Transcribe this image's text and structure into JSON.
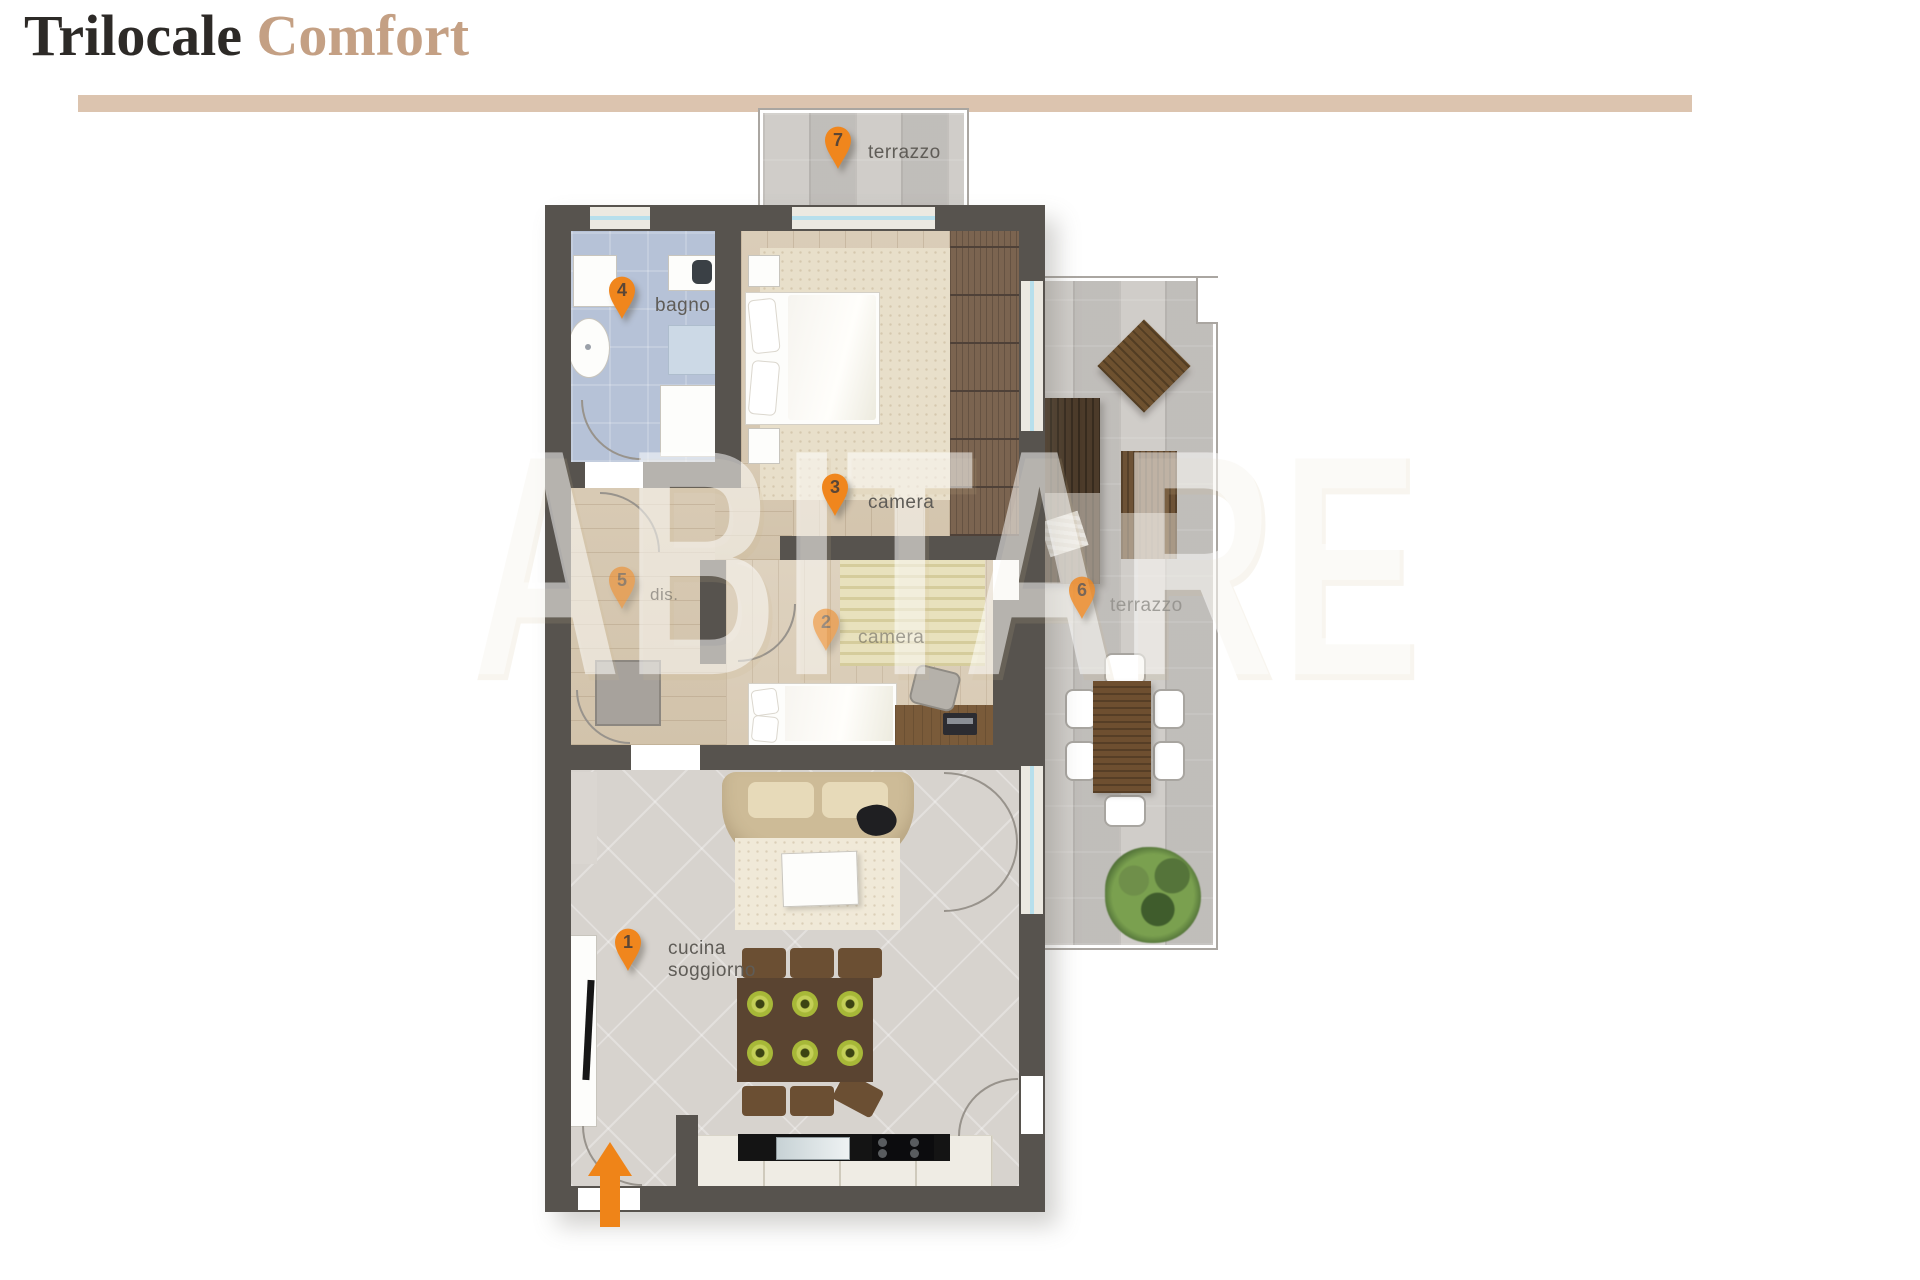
{
  "header": {
    "title_primary": "Trilocale",
    "title_accent": "Comfort"
  },
  "watermark": {
    "text": "ABITARE"
  },
  "markers": [
    {
      "num": "1",
      "label": "cucina soggiorno"
    },
    {
      "num": "2",
      "label": "camera"
    },
    {
      "num": "3",
      "label": "camera"
    },
    {
      "num": "4",
      "label": "bagno"
    },
    {
      "num": "5",
      "label": "dis."
    },
    {
      "num": "6",
      "label": "terrazzo"
    },
    {
      "num": "7",
      "label": "terrazzo"
    }
  ],
  "colors": {
    "accent_orange": "#f0861d",
    "title_accent": "#c4a084",
    "divider": "#dcc4af",
    "wall": "#57534e",
    "bath_floor": "#b6c2d7"
  }
}
